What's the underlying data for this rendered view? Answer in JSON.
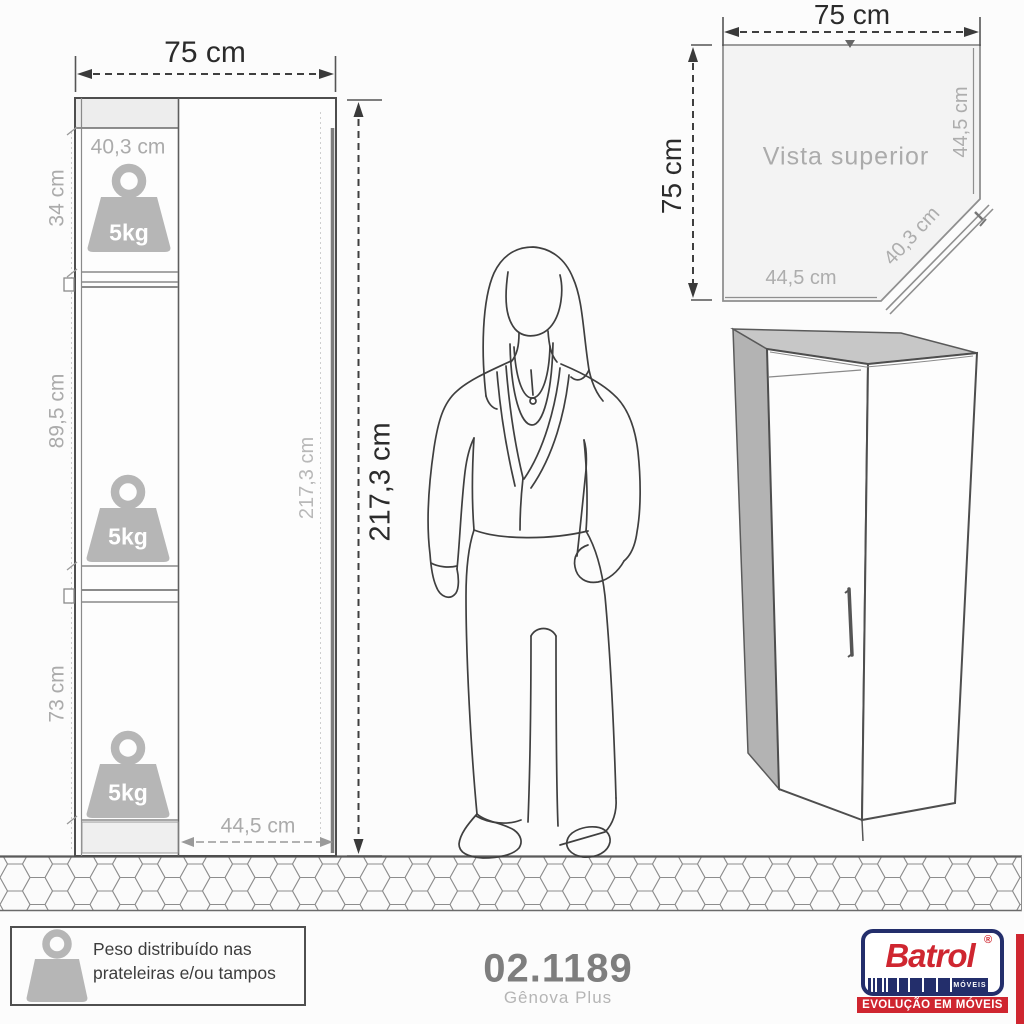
{
  "front_view": {
    "width_label": "75 cm",
    "height_label": "217,3 cm",
    "inner_height_label": "217,3 cm",
    "inner_width_label": "40,3 cm",
    "bottom_width_label": "44,5 cm",
    "section_labels": [
      "34 cm",
      "89,5 cm",
      "73 cm"
    ],
    "weights": [
      "5kg",
      "5kg",
      "5kg"
    ]
  },
  "top_view": {
    "title": "Vista superior",
    "width_label": "75 cm",
    "depth_label": "75 cm",
    "right_label": "44,5 cm",
    "diagonal_label": "40,3 cm",
    "bottom_label": "44,5 cm"
  },
  "footer": {
    "note_line1": "Peso distribuído nas",
    "note_line2": "prateleiras e/ou tampos",
    "product_code": "02.1189",
    "product_name": "Gênova Plus"
  },
  "logo": {
    "brand": "Batrol",
    "registered": "®",
    "moveis": "MÓVEIS",
    "tagline": "EVOLUÇÃO EM MÓVEIS"
  },
  "colors": {
    "logo_navy": "#232e6b",
    "logo_red": "#cf2630",
    "drawing_line": "#4e4e4e",
    "dim_gray": "#ababab",
    "weight_fill": "#b6b6b6",
    "background": "#fcfcfc"
  }
}
